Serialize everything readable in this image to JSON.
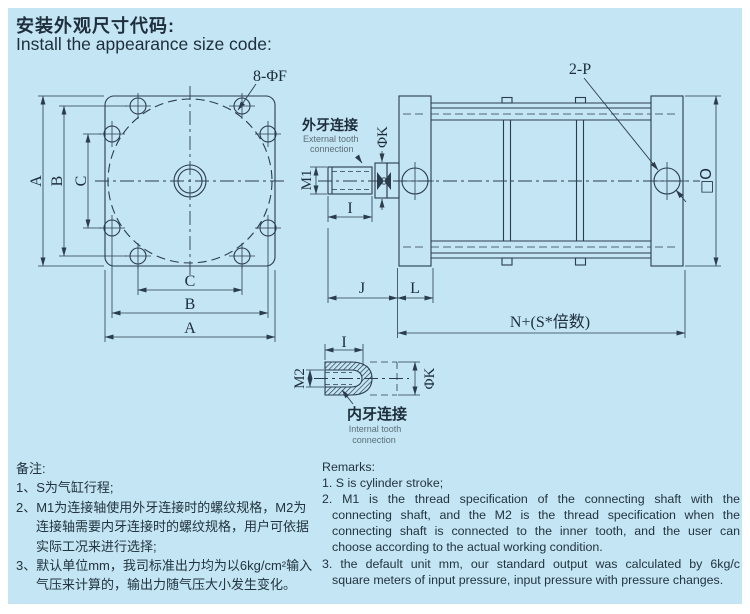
{
  "colors": {
    "panel_bg": "#c3e5f4",
    "line": "#2b3d4d",
    "text": "#1d2d3b",
    "muted": "#5d6e78"
  },
  "title": {
    "zh": "安装外观尺寸代码:",
    "en": "Install the appearance size code:"
  },
  "front_view": {
    "hole_callout": "8-ΦF",
    "dim_left_a": "A",
    "dim_left_b": "B",
    "dim_left_c": "C",
    "dim_bottom_c": "C",
    "dim_bottom_b": "B",
    "dim_bottom_a": "A"
  },
  "side_view": {
    "port_callout": "2-P",
    "m1": "M1",
    "phi_k": "ΦK",
    "dim_i": "I",
    "dim_j": "J",
    "dim_l": "L",
    "dim_n": "N+(S*倍数)",
    "square_o": "□O",
    "external_zh": "外牙连接",
    "external_en1": "External tooth",
    "external_en2": "connection"
  },
  "internal_view": {
    "dim_i": "I",
    "m2": "M2",
    "phi_k": "ΦK",
    "internal_zh": "内牙连接",
    "internal_en1": "Internal tooth",
    "internal_en2": "connection"
  },
  "remarks_zh": {
    "header": "备注:",
    "lines": [
      "1、S为气缸行程;",
      "2、M1为连接轴使用外牙连接时的螺纹规格，M2为",
      "连接轴需要内牙连接时的螺纹规格，用户可依据",
      "实际工况来进行选择;",
      "3、默认单位mm，我司标准出力均为以6kg/cm²输入",
      "气压来计算的，输出力随气压大小发生变化。"
    ]
  },
  "remarks_en": {
    "header": "Remarks:",
    "lines": [
      "1. S is cylinder stroke;",
      "2. M1 is the thread specification of the connecting shaft with the",
      "connecting shaft, and the M2 is the thread specification when the",
      "connecting shaft is connected to the inner tooth, and the user can",
      "choose according to the actual working condition.",
      "3. the default unit mm, our standard output was calculated by 6kg/c",
      "square meters of input pressure, input pressure with pressure changes."
    ]
  }
}
